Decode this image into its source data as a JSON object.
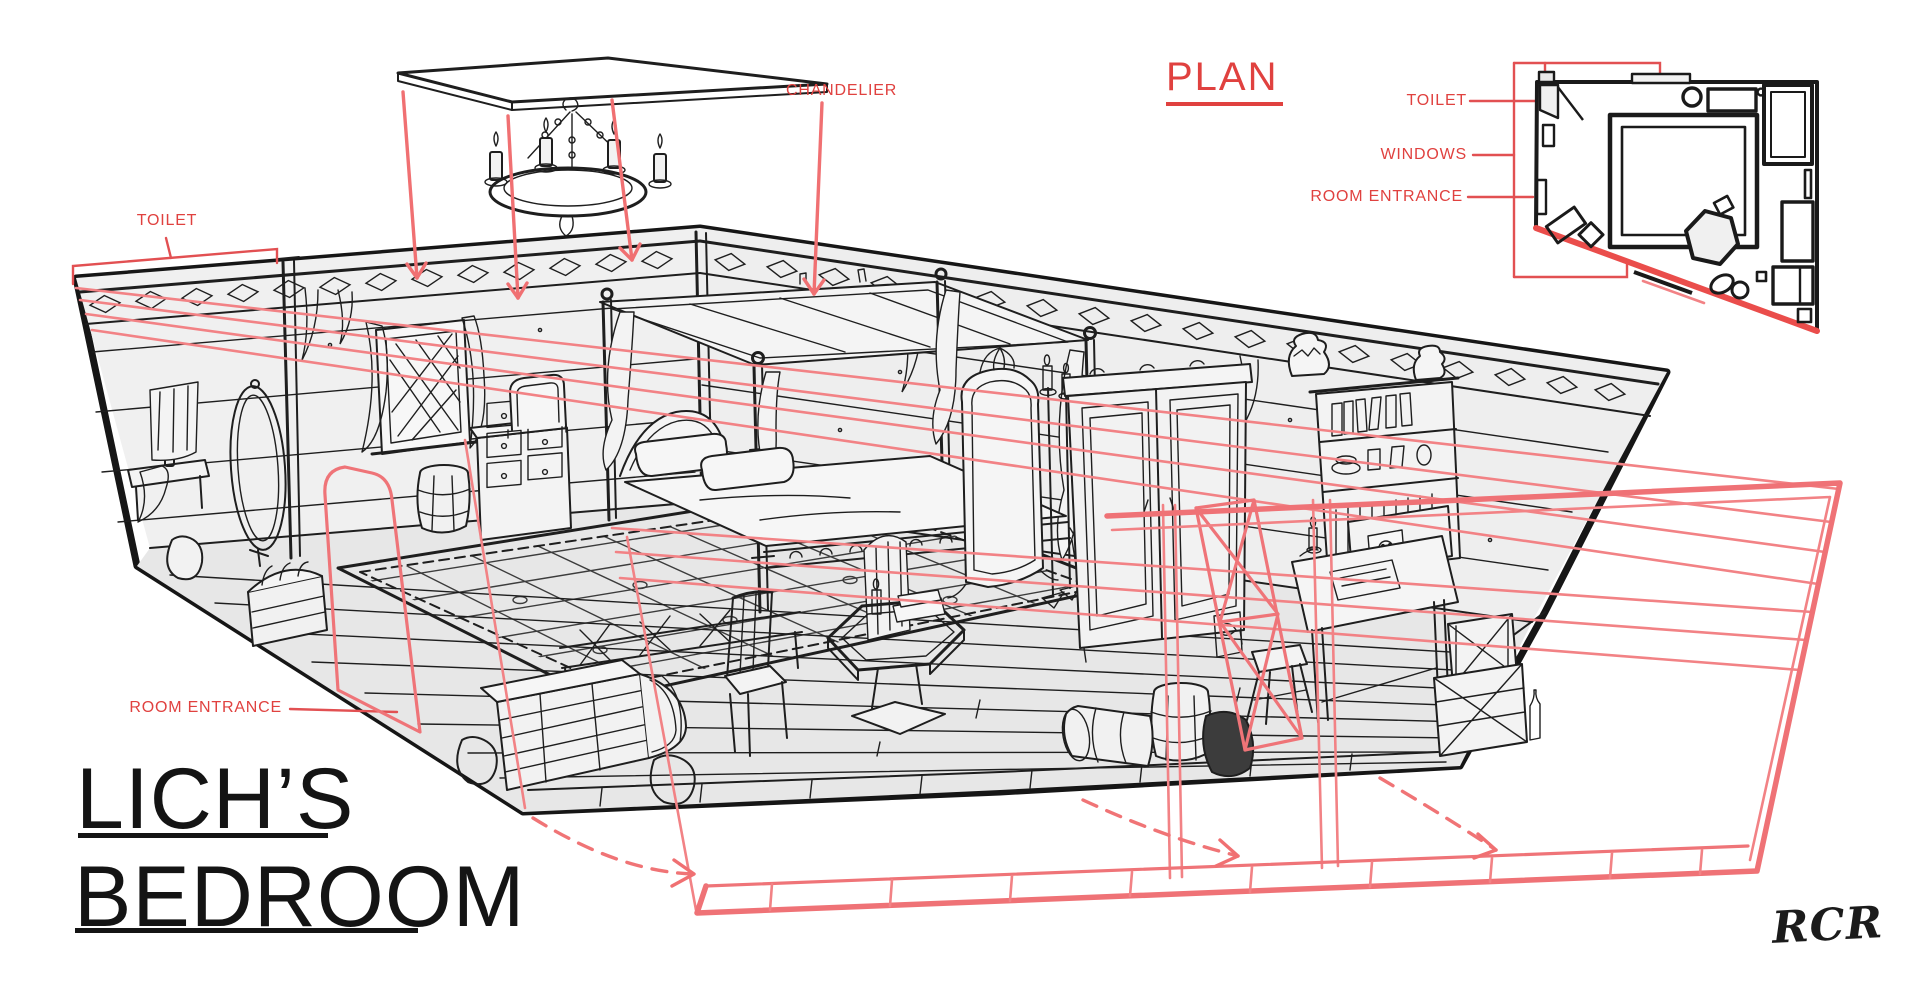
{
  "page": {
    "background": "#ffffff"
  },
  "drawing_title": {
    "line1": "LICH’S",
    "line2": "BEDROOM"
  },
  "signature": "RCR",
  "annotations": {
    "toilet": "TOILET",
    "chandelier": "CHANDELIER",
    "room_entrance": "ROOM ENTRANCE"
  },
  "plan": {
    "title": "PLAN",
    "legend": [
      {
        "label": "TOILET"
      },
      {
        "label": "WINDOWS"
      },
      {
        "label": "ROOM ENTRANCE"
      }
    ]
  },
  "colors": {
    "ink": "#1e1e1e",
    "paper": "#ffffff",
    "wall_fill": "#efefef",
    "floor_fill": "#e8e8e8",
    "label_red": "#e0413f",
    "overlay_salmon": "#f28285",
    "plan_wall_red": "#ea4d4b"
  }
}
